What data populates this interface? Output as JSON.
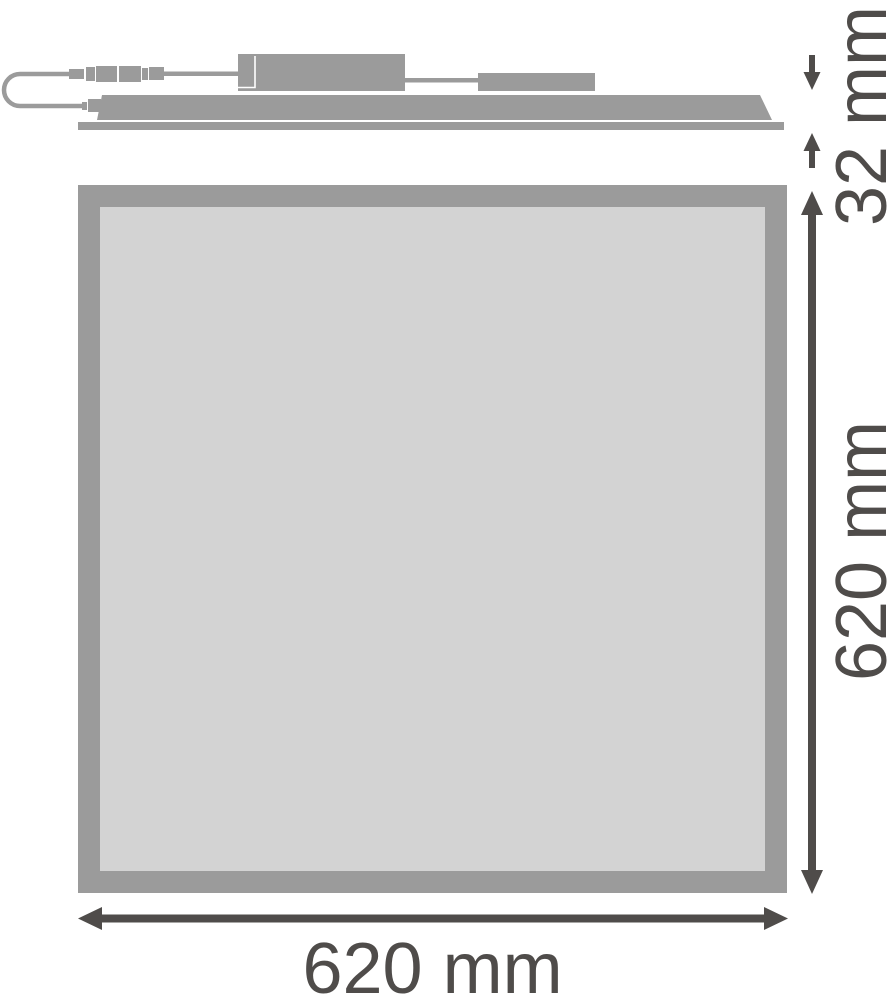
{
  "labels": {
    "thickness": "32 mm",
    "height": "620 mm",
    "width": "620 mm"
  },
  "dimensions": [
    {
      "name": "panel thickness",
      "value": 32,
      "unit": "mm"
    },
    {
      "name": "panel height",
      "value": 620,
      "unit": "mm"
    },
    {
      "name": "panel width",
      "value": 620,
      "unit": "mm"
    }
  ],
  "colors": {
    "product-gray": "#9b9b9b",
    "panel-fill": "#d3d3d3",
    "dimension-ink": "#4f4c4a",
    "background": "#ffffff"
  }
}
